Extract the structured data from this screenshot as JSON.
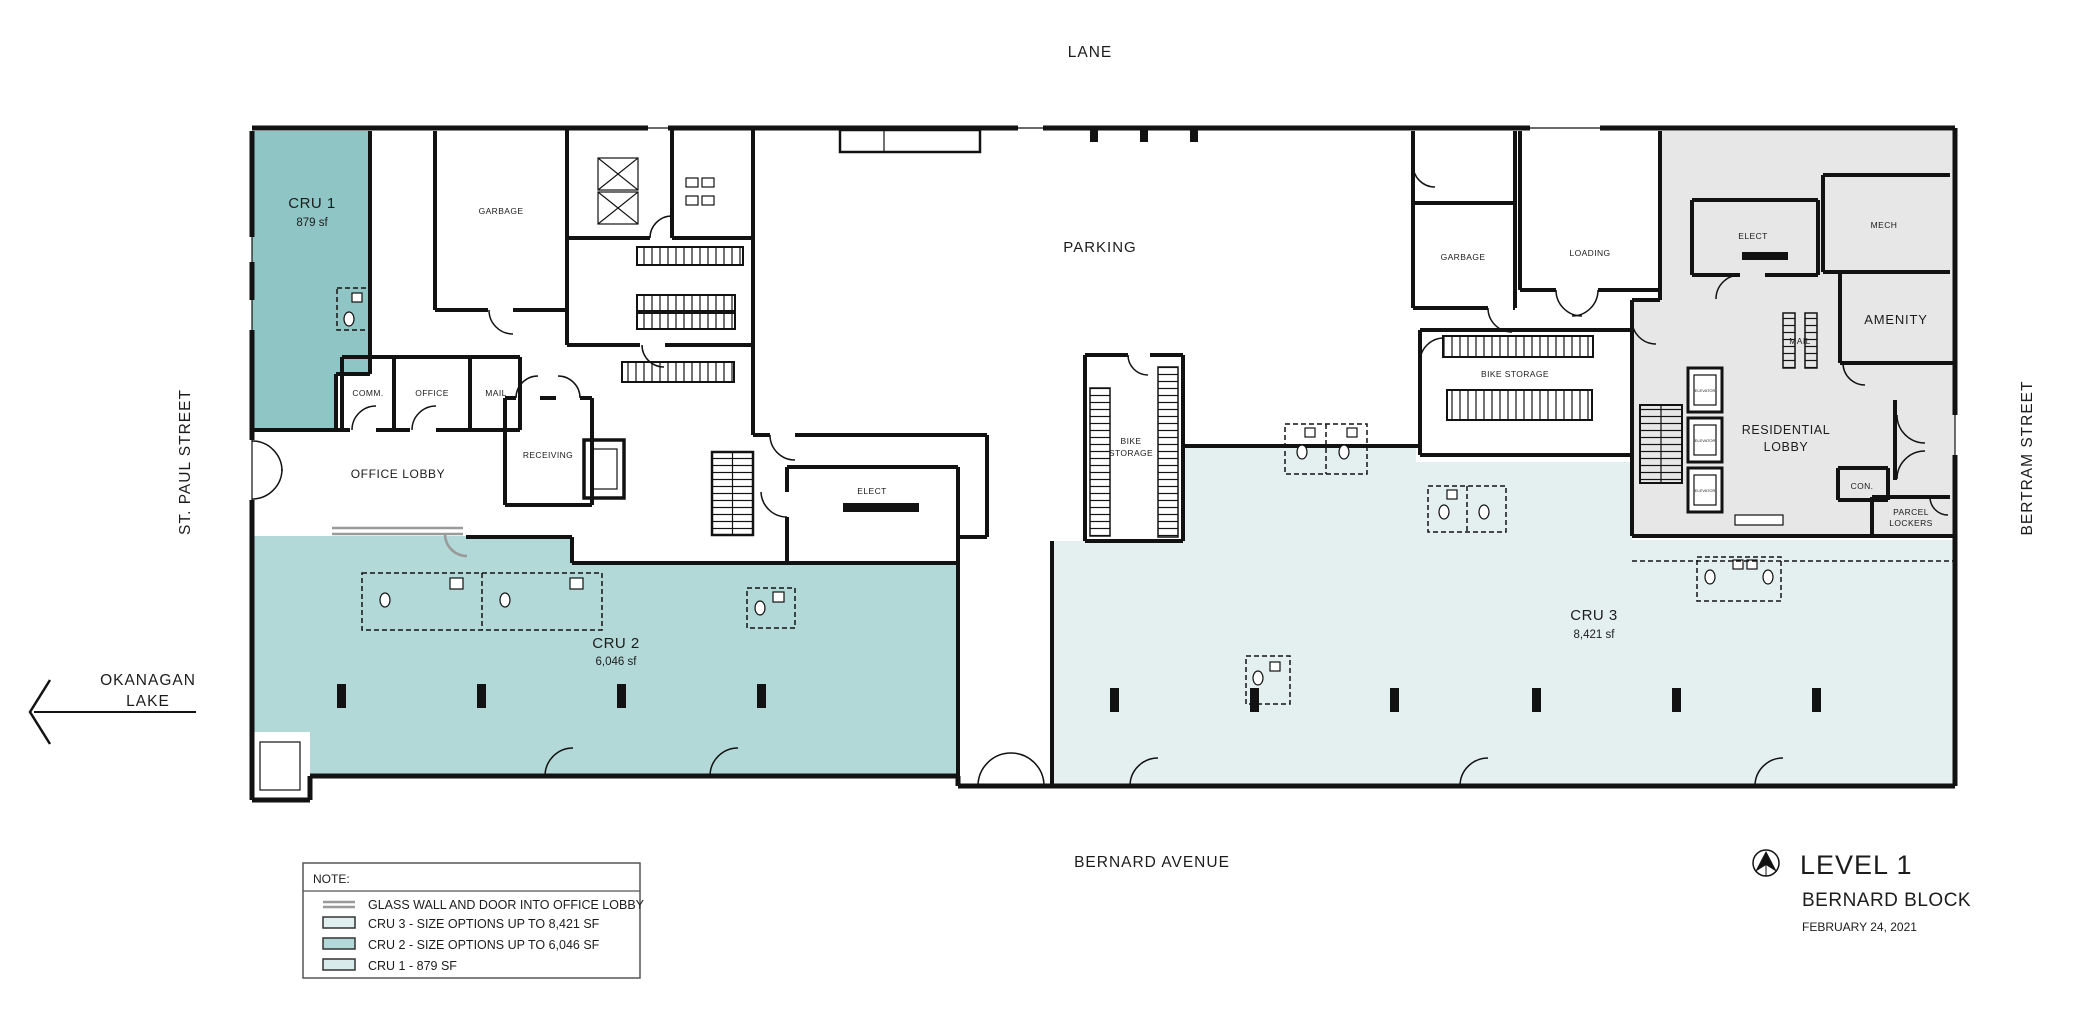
{
  "streets": {
    "lane": "LANE",
    "st_paul": "ST. PAUL STREET",
    "bertram": "BERTRAM STREET",
    "bernard": "BERNARD AVENUE",
    "okanagan_line1": "OKANAGAN",
    "okanagan_line2": "LAKE"
  },
  "units": {
    "cru1": {
      "name": "CRU 1",
      "area": "879 sf"
    },
    "cru2": {
      "name": "CRU 2",
      "area": "6,046 sf"
    },
    "cru3": {
      "name": "CRU 3",
      "area": "8,421 sf"
    }
  },
  "rooms": {
    "parking": "PARKING",
    "garbage_left": "GARBAGE",
    "comm": "COMM.",
    "office": "OFFICE",
    "mail": "MAIL",
    "office_lobby": "OFFICE LOBBY",
    "receiving": "RECEIVING",
    "elect_center": "ELECT",
    "bike_center_line1": "BIKE",
    "bike_center_line2": "STORAGE",
    "garbage_right": "GARBAGE",
    "loading": "LOADING",
    "bike_right": "BIKE STORAGE",
    "elect_res": "ELECT",
    "mech": "MECH",
    "amenity": "AMENITY",
    "mail_res": "MAIL",
    "res_lobby_line1": "RESIDENTIAL",
    "res_lobby_line2": "LOBBY",
    "con": "CON.",
    "parcel_line1": "PARCEL",
    "parcel_line2": "LOCKERS",
    "elevator": "ELEVATOR"
  },
  "legend": {
    "header": "NOTE:",
    "glass_wall": "GLASS WALL AND DOOR INTO OFFICE LOBBY",
    "cru3": "CRU 3 - SIZE OPTIONS UP TO 8,421 SF",
    "cru2": "CRU 2 - SIZE OPTIONS UP TO 6,046 SF",
    "cru1": "CRU 1 - 879 SF"
  },
  "title_block": {
    "level": "LEVEL 1",
    "project": "BERNARD BLOCK",
    "date": "FEBRUARY 24, 2021"
  },
  "colors": {
    "cru1_fill": "#8fc6c5",
    "cru2_fill": "#b2d9d8",
    "cru3_fill": "#e4f0f0",
    "residential_fill": "#e7e7e7",
    "swatch_cru3": "#dfeeee",
    "swatch_cru2": "#b2d9d8",
    "swatch_cru1": "#d8ebeb",
    "wall": "#121212",
    "glass": "#9a9a9a"
  }
}
